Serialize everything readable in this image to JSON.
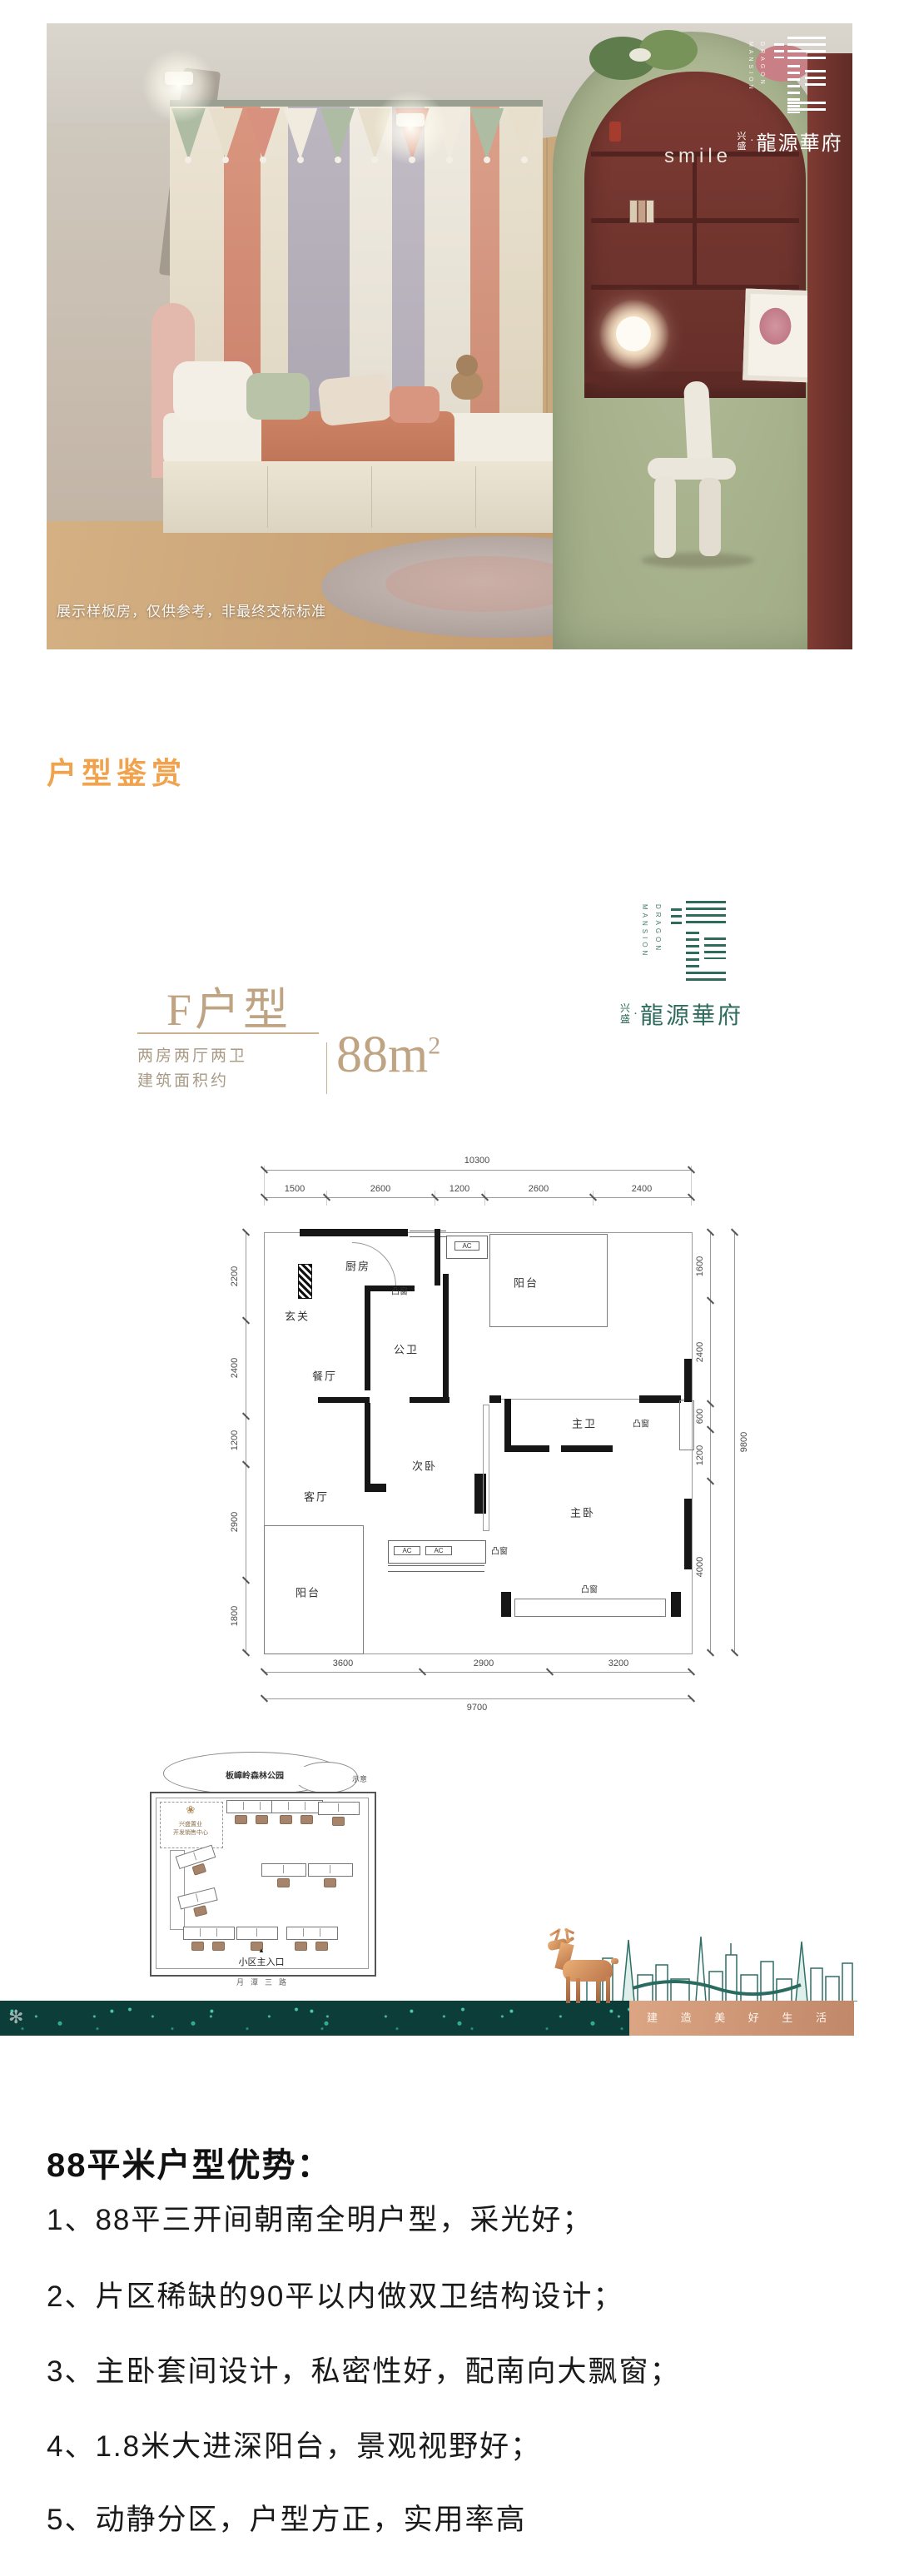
{
  "section": {
    "title": "户型鉴赏",
    "accent_color": "#F0A24D"
  },
  "hero": {
    "watermark": "展示样板房，仅供参考，非最终交标标准",
    "decor_word": "smile",
    "logo": {
      "en1": "DRAGON",
      "en2": "MANSION",
      "cn_prefix": "兴盛",
      "separator": "·",
      "cn_name": "龍源華府"
    }
  },
  "unit": {
    "name": "F户型",
    "spec_line1": "两房两厅两卫",
    "spec_line2": "建筑面积约",
    "area": "88m",
    "area_sup": "2",
    "brand": {
      "en1": "DRAGON",
      "en2": "MANSION",
      "cn_prefix": "兴盛",
      "separator": "·",
      "cn_name": "龍源華府",
      "color": "#2E6B5C"
    }
  },
  "floorplan": {
    "dims": {
      "top_total": "10300",
      "top": [
        "1500",
        "2600",
        "1200",
        "2600",
        "2400"
      ],
      "left": [
        "2200",
        "2400",
        "1200",
        "2900",
        "1800"
      ],
      "right": [
        "1600",
        "2400",
        "600",
        "1200",
        "4000"
      ],
      "right_total": "9800",
      "bottom": [
        "3600",
        "2900",
        "3200"
      ],
      "bottom_total": "9700"
    },
    "rooms": {
      "entry": "玄关",
      "kitchen": "厨房",
      "dining": "餐厅",
      "living": "客厅",
      "bath_public": "公卫",
      "bath_master": "主卫",
      "bed_second": "次卧",
      "bed_master": "主卧",
      "balcony_top": "阳台",
      "balcony_bottom": "阳台",
      "bay_top": "凸窗",
      "bay_right": "凸窗",
      "bay_mid": "凸窗",
      "bay_bottom": "凸窗",
      "ac": "AC"
    }
  },
  "siteplan": {
    "park": "板嶂岭森林公园",
    "note": "示意",
    "office_line1": "兴盛置业",
    "office_line2": "开发销售中心",
    "entrance_marker": "▲",
    "entrance": "小区主入口",
    "road": "月潭三路"
  },
  "banner": {
    "slogan": "建 造 美 好 生 活"
  },
  "advantages": {
    "heading": "88平米户型优势：",
    "items": [
      "1、88平三开间朝南全明户型，采光好；",
      "2、片区稀缺的90平以内做双卫结构设计；",
      "3、主卧套间设计，私密性好，配南向大飘窗；",
      "4、1.8米大进深阳台，景观视野好；",
      "5、动静分区，户型方正，实用率高"
    ]
  }
}
